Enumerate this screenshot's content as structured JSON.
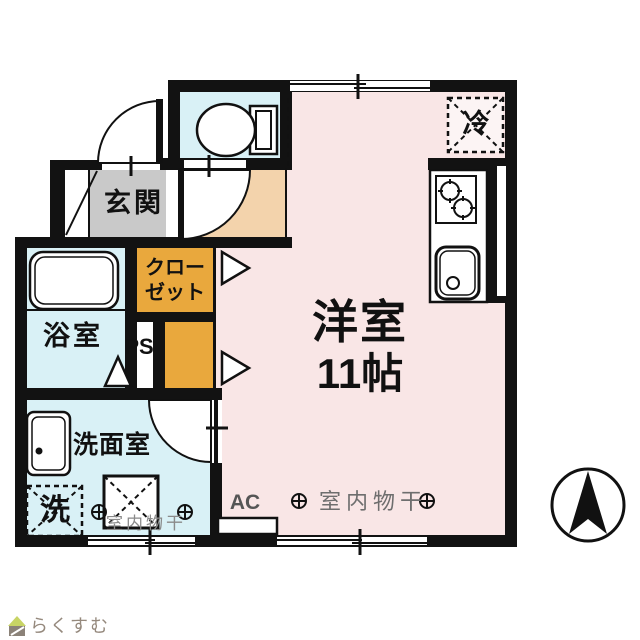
{
  "plan_type": "japanese-apartment-floor-plan",
  "colors": {
    "wall": "#121212",
    "main-floor": "#f9e6e6",
    "hall-floor": "#f3d3ac",
    "genkan-floor": "#c9c9c9",
    "wet-floor": "#d9f1f6",
    "closet-floor": "#e9a83d",
    "logo-roof": "#c8d465",
    "logo-body": "#8b8278",
    "logo-text-color": "#95897d"
  },
  "rooms": {
    "genkan": {
      "label": "玄関"
    },
    "bathroom": {
      "label": "浴室"
    },
    "closet": {
      "label": "クロー\nゼット"
    },
    "pipe_space": {
      "label": "PS"
    },
    "washroom": {
      "label": "洗面室"
    },
    "main_room": {
      "label": "洋室",
      "size": "11帖"
    }
  },
  "fixtures": {
    "washer_label": "洗",
    "fridge_label": "冷",
    "ac_label": "AC",
    "indoor_drying_main": "室内物干",
    "indoor_drying_washroom": "室内物干"
  },
  "branding": {
    "logo_text": "らくすむ"
  }
}
